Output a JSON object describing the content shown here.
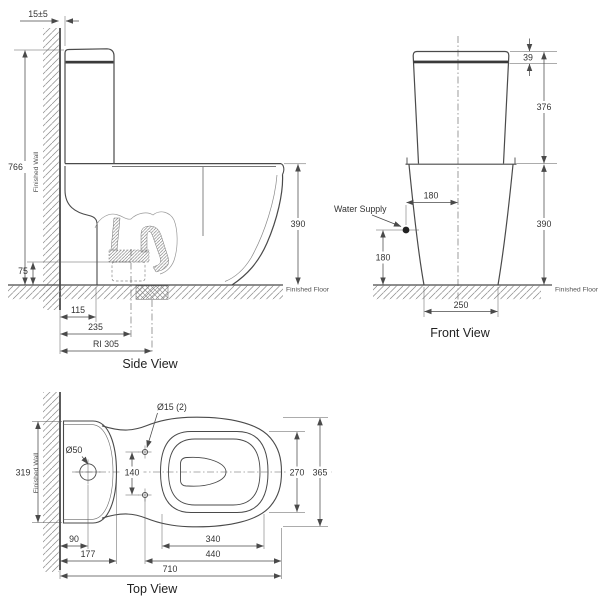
{
  "colors": {
    "line": "#4a4a4a",
    "dim_line": "#5a5a5a",
    "text": "#333333",
    "lid_seam": "#3a3a3a",
    "background": "#ffffff"
  },
  "side_view": {
    "title": "Side View",
    "finished_wall": "Finished Wall",
    "finished_floor": "Finished Floor",
    "dims": {
      "wall_gap": "15±5",
      "total_height": "766",
      "bowl_height": "390",
      "trap_center_height": "75",
      "wall_to_pedestal": "115",
      "wall_to_outlet": "235",
      "rough_in": "RI 305"
    }
  },
  "front_view": {
    "title": "Front View",
    "water_supply": "Water Supply",
    "finished_floor": "Finished Floor",
    "dims": {
      "lid_height": "39",
      "tank_height": "376",
      "bowl_height": "390",
      "supply_to_center": "180",
      "supply_above_floor": "180",
      "base_width": "250"
    }
  },
  "top_view": {
    "title": "Top View",
    "finished_wall": "Finished Wall",
    "dims": {
      "tank_width": "319",
      "supply_hole_dia": "Ø50",
      "bolt_hole_dia": "Ø15 (2)",
      "bolt_spacing": "140",
      "seat_width": "270",
      "overall_width": "365",
      "wall_to_supply": "90",
      "tank_depth": "177",
      "seat_length": "340",
      "bolt_to_front": "440",
      "overall_length": "710"
    }
  }
}
